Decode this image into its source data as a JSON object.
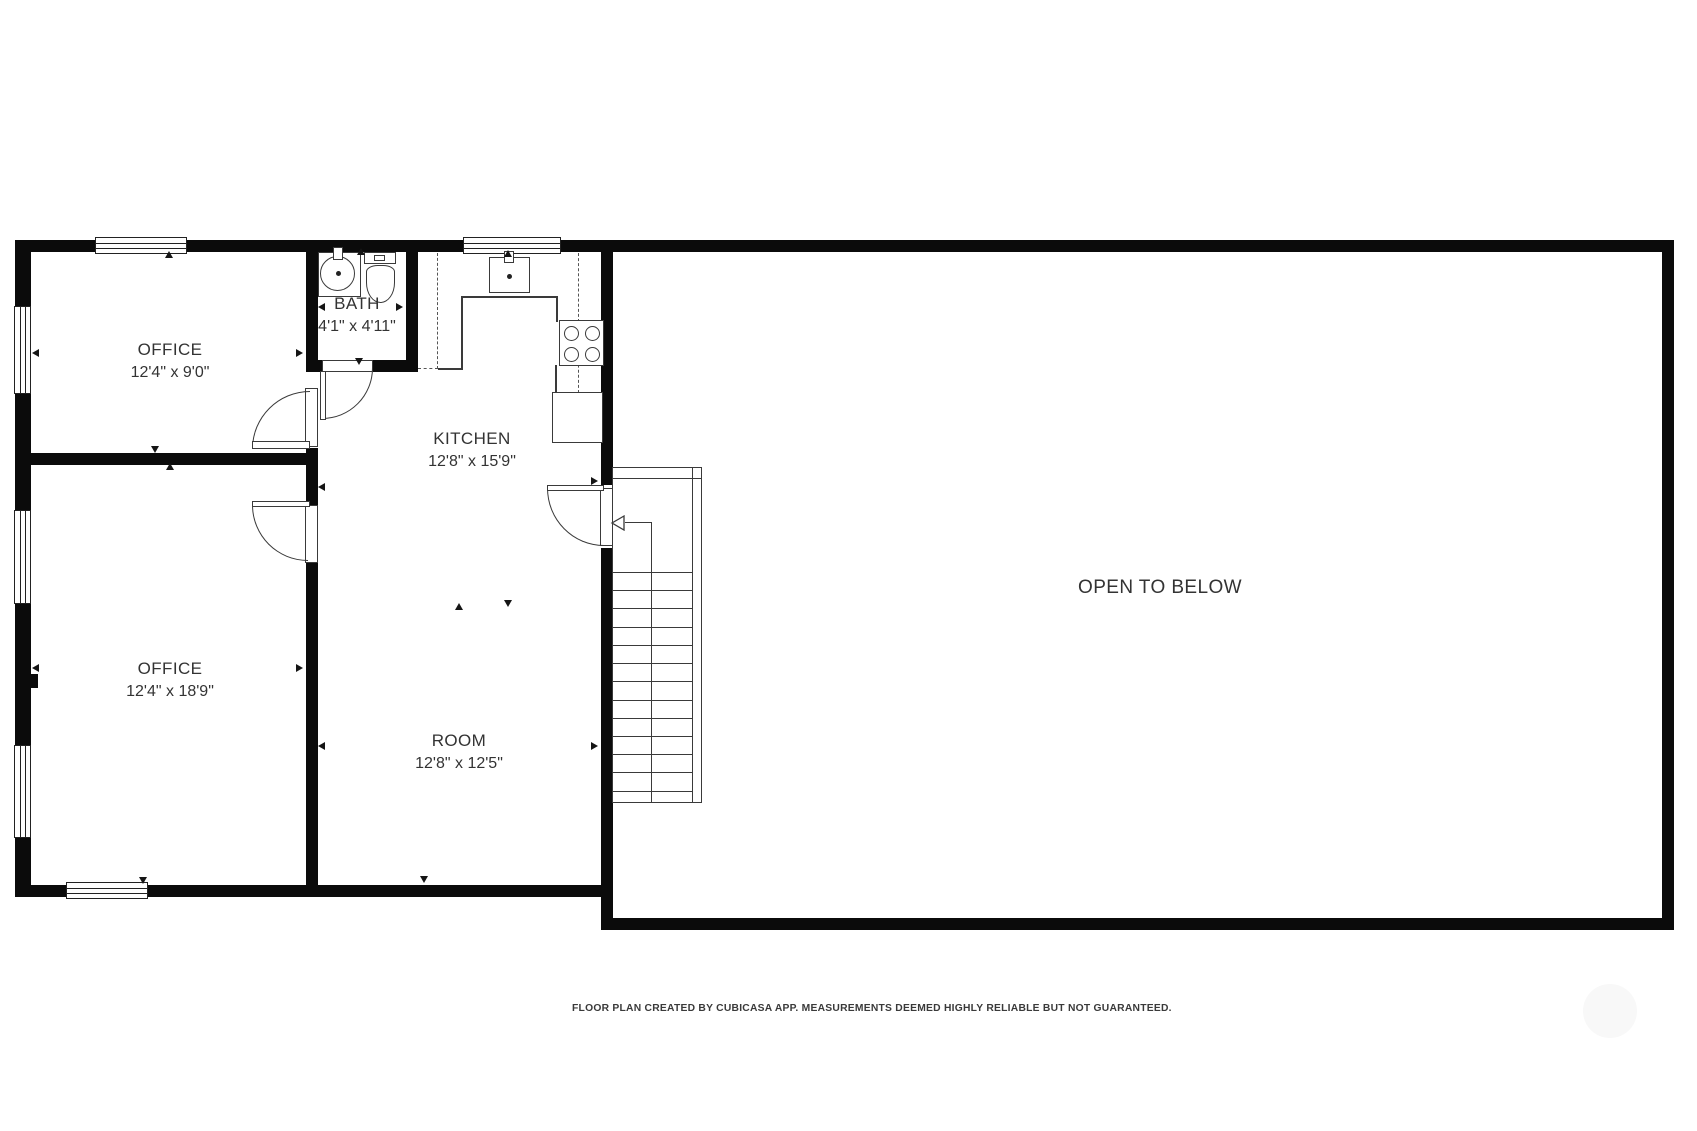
{
  "floorplan": {
    "rooms": [
      {
        "name": "OFFICE",
        "dims": "12'4\" x 9'0\""
      },
      {
        "name": "BATH",
        "dims": "4'1\" x 4'11\""
      },
      {
        "name": "KITCHEN",
        "dims": "12'8\" x 15'9\""
      },
      {
        "name": "OFFICE",
        "dims": "12'4\" x 18'9\""
      },
      {
        "name": "ROOM",
        "dims": "12'8\" x 12'5\""
      },
      {
        "name": "OPEN TO BELOW",
        "dims": ""
      }
    ],
    "footer_note": "FLOOR PLAN CREATED BY CUBICASA APP. MEASUREMENTS DEEMED HIGHLY RELIABLE BUT NOT GUARANTEED.",
    "fixtures": [
      "bath-sink",
      "toilet",
      "kitchen-sink",
      "stove",
      "refrigerator",
      "staircase"
    ],
    "colors": {
      "wall": "#0b0b0b",
      "line": "#3a3a3a",
      "text": "#333333",
      "dashed": "#555555",
      "background": "#ffffff",
      "watermark": "#f4f4f4"
    }
  }
}
